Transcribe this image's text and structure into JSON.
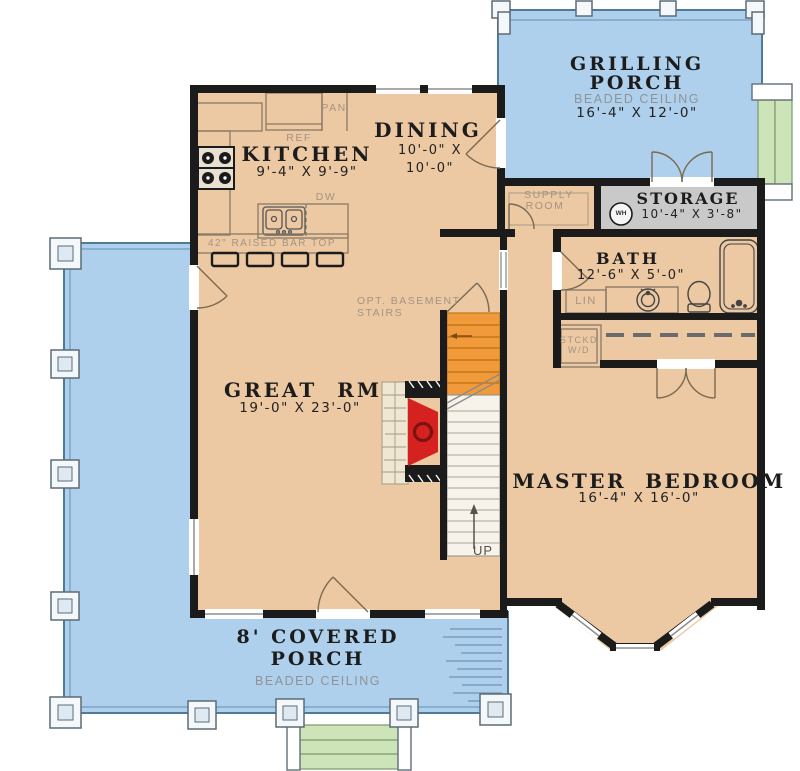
{
  "rooms": {
    "grilling_porch": {
      "name_line1": "GRILLING",
      "name_line2": "PORCH",
      "ceiling": "BEADED CEILING",
      "dims": "16'-4\" X 12'-0\""
    },
    "storage": {
      "name": "STORAGE",
      "dims": "10'-4\" X 3'-8\""
    },
    "supply_room": {
      "name_line1": "SUPPLY",
      "name_line2": "ROOM"
    },
    "dining": {
      "name": "DINING",
      "dims_line1": "10'-0\" X",
      "dims_line2": "10'-0\""
    },
    "kitchen": {
      "name": "KITCHEN",
      "dims": "9'-4\" X 9'-9\""
    },
    "bath": {
      "name": "BATH",
      "dims": "12'-6\" X 5'-0\""
    },
    "great_room": {
      "name": "GREAT  RM",
      "dims": "19'-0\" X 23'-0\""
    },
    "master_bedroom": {
      "name": "MASTER  BEDROOM",
      "dims": "16'-4\" X 16'-0\""
    },
    "covered_porch": {
      "name_line1": "8' COVERED",
      "name_line2": "PORCH",
      "ceiling": "BEADED CEILING"
    }
  },
  "labels": {
    "pantry": "PAN",
    "refrigerator": "REF",
    "dishwasher": "DW",
    "bar_top": "42\" RAISED BAR TOP",
    "opt_basement_line1": "OPT. BASEMENT",
    "opt_basement_line2": "STAIRS",
    "linen": "LIN",
    "stacked_wd_line1": "STCKD",
    "stacked_wd_line2": "W/D",
    "water_heater": "WH",
    "stairs_up": "UP"
  },
  "colors": {
    "floor_tan": "#ecc9a3",
    "porch_blue": "#aed0ec",
    "storage_gray": "#c9c9c9",
    "basement_stairs_orange": "#f09a3c",
    "fireplace_red": "#d62121",
    "steps_green": "#cde4b8",
    "walls_black": "#1b1b1b"
  }
}
